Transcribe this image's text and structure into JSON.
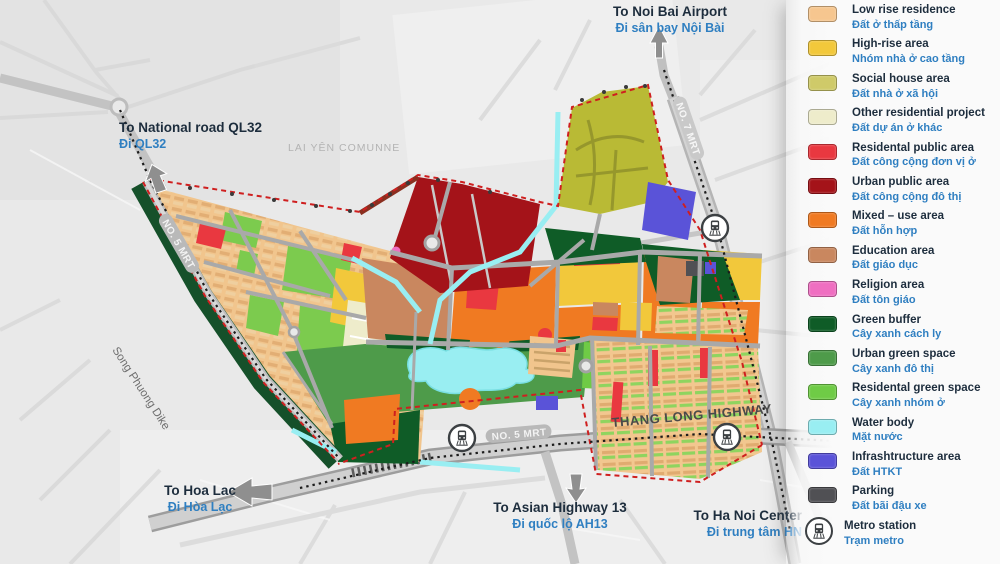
{
  "map": {
    "area_label": "LAI YÊN COMUNNE",
    "dike_label": "Song Phuong Dike",
    "roads": {
      "thang_long": "THANG LONG HIGHWAY",
      "mrt5_south": "NO. 5 MRT",
      "mrt5_west": "NO. 5 MRT",
      "mrt7": "NO. 7 MRT"
    },
    "directions": {
      "noi_bai": {
        "en": "To Noi Bai Airport",
        "vi": "Đi sân bay Nội Bài"
      },
      "ql32": {
        "en": "To National road QL32",
        "vi": "Đi QL32"
      },
      "hoa_lac": {
        "en": "To Hoa Lac",
        "vi": "Đi Hòa Lạc"
      },
      "ah13": {
        "en": "To Asian Highway 13",
        "vi": "Đi quốc lộ AH13"
      },
      "hanoi": {
        "en": "To Ha Noi Center",
        "vi": "Đi trung tâm HN"
      }
    },
    "text_colors": {
      "english": "#1d2d3d",
      "vietnamese": "#2f7fc1"
    }
  },
  "legend": {
    "items": [
      {
        "en": "Low rise residence",
        "vi": "Đất ở thấp tầng",
        "color": "#f6c68f"
      },
      {
        "en": "High-rise area",
        "vi": "Nhóm nhà ở cao tầng",
        "color": "#f2c83b"
      },
      {
        "en": "Social house area",
        "vi": "Đất nhà ở xã hội",
        "color": "#cfca69"
      },
      {
        "en": "Other residential project",
        "vi": "Đất dự án ở khác",
        "color": "#eeeccb"
      },
      {
        "en": "Residental public area",
        "vi": "Đất công cộng đơn vị ở",
        "color": "#e93840"
      },
      {
        "en": "Urban public area",
        "vi": "Đất công cộng đô thị",
        "color": "#a41319"
      },
      {
        "en": "Mixed – use area",
        "vi": "Đất hỗn hợp",
        "color": "#f07a22"
      },
      {
        "en": "Education area",
        "vi": "Đất giáo dục",
        "color": "#c9875f"
      },
      {
        "en": "Religion area",
        "vi": "Đất tôn giáo",
        "color": "#ef6fc1"
      },
      {
        "en": "Green buffer",
        "vi": "Cây xanh cách ly",
        "color": "#0f5c27"
      },
      {
        "en": "Urban green space",
        "vi": "Cây xanh đô thị",
        "color": "#4e9b4a"
      },
      {
        "en": "Residental green space",
        "vi": "Cây xanh nhóm ở",
        "color": "#6fcb46"
      },
      {
        "en": "Water body",
        "vi": "Mặt nước",
        "color": "#99eef2"
      },
      {
        "en": "Infrashtructure area",
        "vi": "Đất HTKT",
        "color": "#5a53d8"
      },
      {
        "en": "Parking",
        "vi": "Đất bãi đậu xe",
        "color": "#505054"
      },
      {
        "en": "Metro station",
        "vi": "Trạm metro",
        "icon": "metro-station-icon"
      }
    ]
  }
}
